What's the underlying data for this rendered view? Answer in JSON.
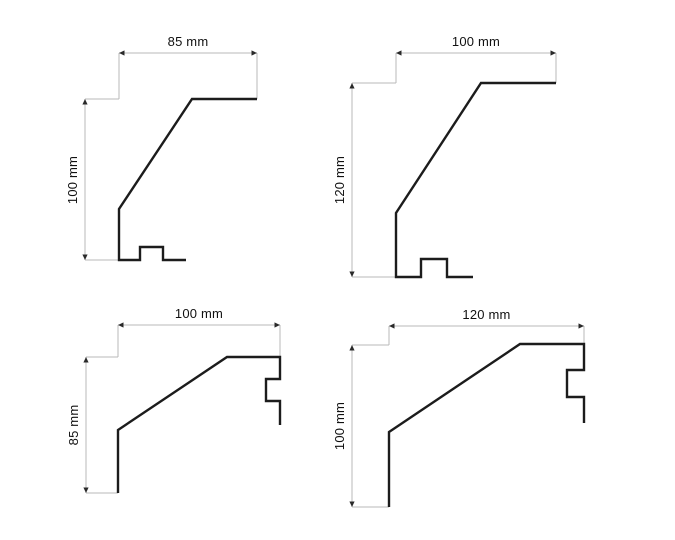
{
  "canvas": {
    "width": 675,
    "height": 540,
    "background": "#ffffff"
  },
  "style": {
    "profile_color": "#1c1c1c",
    "profile_stroke_width": 2.4,
    "dim_line_color": "#b9b9b9",
    "dim_stroke_width": 1,
    "arrow_color": "#2a2a2a",
    "label_color": "#111111"
  },
  "diagrams": [
    {
      "name": "profile-top-left",
      "width_label": "85 mm",
      "height_label": "100 mm",
      "profile_points": [
        [
          257,
          99
        ],
        [
          192,
          99
        ],
        [
          119,
          209
        ],
        [
          119,
          260
        ],
        [
          140,
          260
        ],
        [
          140,
          247
        ],
        [
          163,
          247
        ],
        [
          163,
          260
        ],
        [
          186,
          260
        ]
      ],
      "h_dim": {
        "x1": 119,
        "x2": 257,
        "y": 53
      },
      "v_dim": {
        "x": 85,
        "y1": 99,
        "y2": 260
      },
      "extension_lines": [
        {
          "x1": 119,
          "y1": 53,
          "x2": 119,
          "y2": 99
        },
        {
          "x1": 257,
          "y1": 53,
          "x2": 257,
          "y2": 99
        },
        {
          "x1": 85,
          "y1": 99,
          "x2": 119,
          "y2": 99
        },
        {
          "x1": 85,
          "y1": 260,
          "x2": 119,
          "y2": 260
        }
      ]
    },
    {
      "name": "profile-top-right",
      "width_label": "100 mm",
      "height_label": "120 mm",
      "profile_points": [
        [
          556,
          83
        ],
        [
          481,
          83
        ],
        [
          396,
          213
        ],
        [
          396,
          277
        ],
        [
          421,
          277
        ],
        [
          421,
          259
        ],
        [
          447,
          259
        ],
        [
          447,
          277
        ],
        [
          473,
          277
        ]
      ],
      "h_dim": {
        "x1": 396,
        "x2": 556,
        "y": 53
      },
      "v_dim": {
        "x": 352,
        "y1": 83,
        "y2": 277
      },
      "extension_lines": [
        {
          "x1": 396,
          "y1": 53,
          "x2": 396,
          "y2": 83
        },
        {
          "x1": 556,
          "y1": 53,
          "x2": 556,
          "y2": 83
        },
        {
          "x1": 352,
          "y1": 83,
          "x2": 396,
          "y2": 83
        },
        {
          "x1": 352,
          "y1": 277,
          "x2": 396,
          "y2": 277
        }
      ]
    },
    {
      "name": "profile-bottom-left",
      "width_label": "100 mm",
      "height_label": "85 mm",
      "profile_points": [
        [
          118,
          493
        ],
        [
          118,
          430
        ],
        [
          227,
          357
        ],
        [
          280,
          357
        ],
        [
          280,
          379
        ],
        [
          266,
          379
        ],
        [
          266,
          401
        ],
        [
          280,
          401
        ],
        [
          280,
          425
        ]
      ],
      "h_dim": {
        "x1": 118,
        "x2": 280,
        "y": 325
      },
      "v_dim": {
        "x": 86,
        "y1": 357,
        "y2": 493
      },
      "extension_lines": [
        {
          "x1": 118,
          "y1": 325,
          "x2": 118,
          "y2": 357
        },
        {
          "x1": 280,
          "y1": 325,
          "x2": 280,
          "y2": 357
        },
        {
          "x1": 86,
          "y1": 357,
          "x2": 118,
          "y2": 357
        },
        {
          "x1": 86,
          "y1": 493,
          "x2": 118,
          "y2": 493
        }
      ]
    },
    {
      "name": "profile-bottom-right",
      "width_label": "120 mm",
      "height_label": "100 mm",
      "profile_points": [
        [
          389,
          507
        ],
        [
          389,
          432
        ],
        [
          520,
          344
        ],
        [
          584,
          344
        ],
        [
          584,
          370
        ],
        [
          567,
          370
        ],
        [
          567,
          397
        ],
        [
          584,
          397
        ],
        [
          584,
          423
        ]
      ],
      "h_dim": {
        "x1": 389,
        "x2": 584,
        "y": 326
      },
      "v_dim": {
        "x": 352,
        "y1": 345,
        "y2": 507
      },
      "extension_lines": [
        {
          "x1": 389,
          "y1": 326,
          "x2": 389,
          "y2": 345
        },
        {
          "x1": 584,
          "y1": 326,
          "x2": 584,
          "y2": 344
        },
        {
          "x1": 352,
          "y1": 345,
          "x2": 389,
          "y2": 345
        },
        {
          "x1": 352,
          "y1": 507,
          "x2": 389,
          "y2": 507
        }
      ]
    }
  ]
}
